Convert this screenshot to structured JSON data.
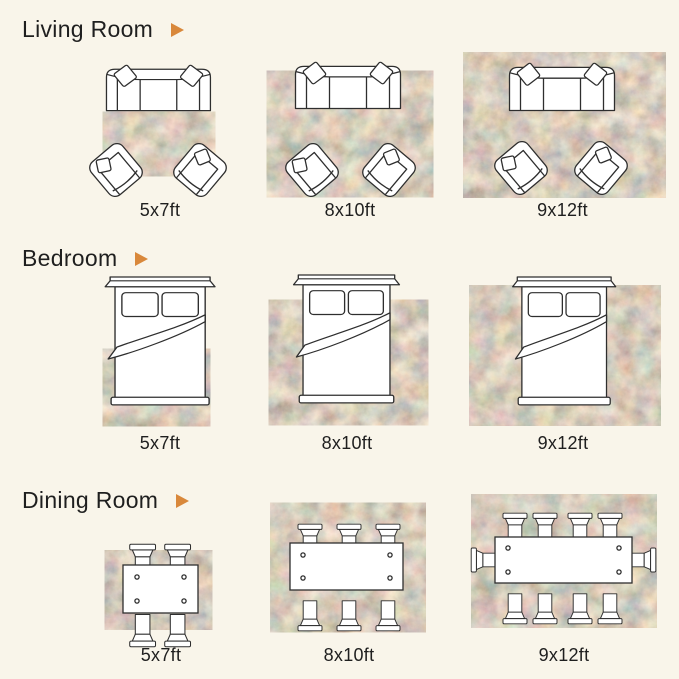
{
  "page": {
    "background_color": "#F9F5EA",
    "accent_color": "#D9883B",
    "ink_color": "#1F1F1F",
    "kind": "rug size guide infographic"
  },
  "rug": {
    "palette": [
      "#a1543c",
      "#9a9a6e",
      "#d9cdb2",
      "#8b9390",
      "#c8b48e"
    ]
  },
  "sections": [
    {
      "id": "living-room",
      "title": "Living Room",
      "furniture": "sofa with two accent chairs",
      "figures": [
        {
          "size_label": "5x7ft"
        },
        {
          "size_label": "8x10ft"
        },
        {
          "size_label": "9x12ft"
        }
      ]
    },
    {
      "id": "bedroom",
      "title": "Bedroom",
      "furniture": "bed with headboard, two pillows and folded blanket",
      "figures": [
        {
          "size_label": "5x7ft"
        },
        {
          "size_label": "8x10ft"
        },
        {
          "size_label": "9x12ft"
        }
      ]
    },
    {
      "id": "dining-room",
      "title": "Dining Room",
      "furniture": "dining table with chairs",
      "figures": [
        {
          "size_label": "5x7ft"
        },
        {
          "size_label": "8x10ft"
        },
        {
          "size_label": "9x12ft"
        }
      ]
    }
  ]
}
